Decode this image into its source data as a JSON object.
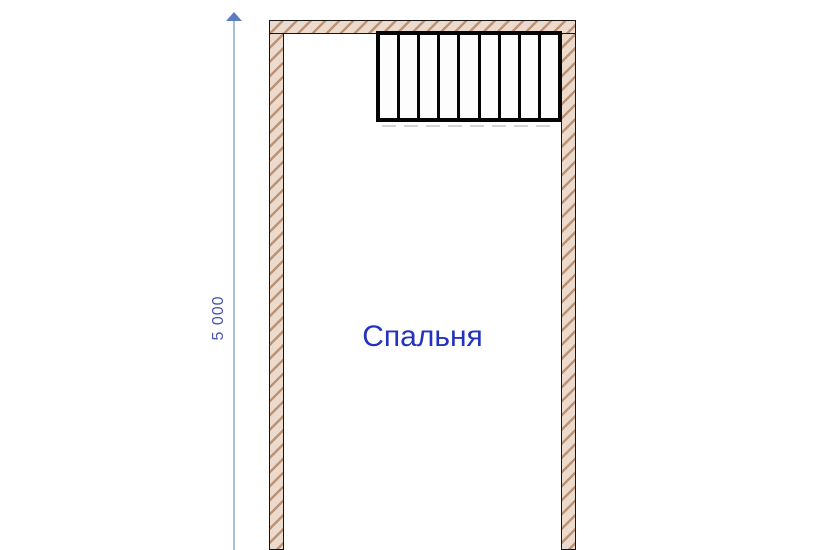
{
  "plan": {
    "room": {
      "label": "Спальня"
    },
    "dimension": {
      "label": "5 000"
    },
    "stairs": {
      "treads": 9
    }
  },
  "colors": {
    "background": "#ffffff",
    "wall_fill": "#ecdbcc",
    "wall_hatch": "#bb9478",
    "wall_outline": "#141414",
    "stair_outline": "#050505",
    "stair_shadow": "#d4d4d4",
    "dimension_line": "#a3c0de",
    "dimension_arrow": "#5c7cc0",
    "dimension_text": "#4a55b5",
    "room_label": "#2433bd"
  }
}
